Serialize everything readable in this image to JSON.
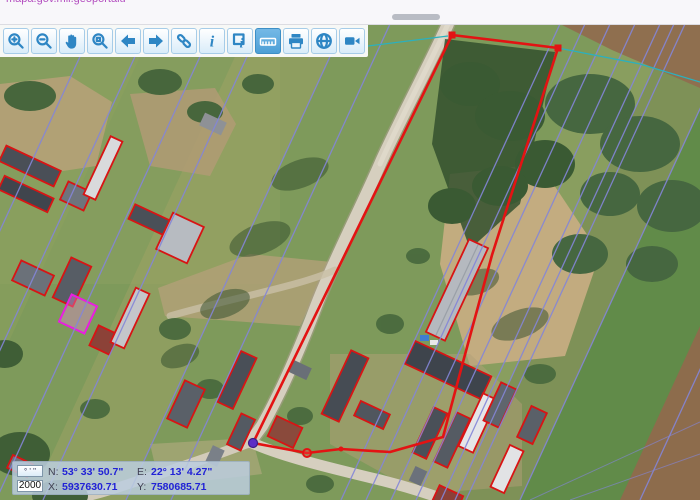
{
  "browser_bar": {
    "link_text": "mapa.gov.mil.geoportalu"
  },
  "toolbar": {
    "buttons": [
      {
        "name": "zoom-in",
        "active": false
      },
      {
        "name": "zoom-out",
        "active": false
      },
      {
        "name": "pan",
        "active": false
      },
      {
        "name": "zoom-window",
        "active": false
      },
      {
        "name": "previous-view",
        "active": false
      },
      {
        "name": "next-view",
        "active": false
      },
      {
        "name": "link",
        "active": false
      },
      {
        "name": "info",
        "active": false
      },
      {
        "name": "identify",
        "active": false
      },
      {
        "name": "measure",
        "active": true
      },
      {
        "name": "print",
        "active": false
      },
      {
        "name": "globe",
        "active": false
      },
      {
        "name": "camera",
        "active": false
      }
    ]
  },
  "coordinate_panel": {
    "dms_toggle_label": "° ' \"",
    "scale_value": "2000",
    "north": {
      "label": "N:",
      "value": "53° 33' 50.7\""
    },
    "east": {
      "label": "E:",
      "value": "22° 13' 4.27\""
    },
    "x": {
      "label": "X:",
      "value": "5937630.71"
    },
    "y": {
      "label": "Y:",
      "value": "7580685.71"
    }
  },
  "map": {
    "colors": {
      "parcel_highlight": "#e31313",
      "building_outline": "#d81414",
      "selected_building": "#e91ee0",
      "cadastral_line": "#8486d8",
      "utility_line": "#2cb0bd",
      "measure_point": "#5c2ec6"
    }
  }
}
